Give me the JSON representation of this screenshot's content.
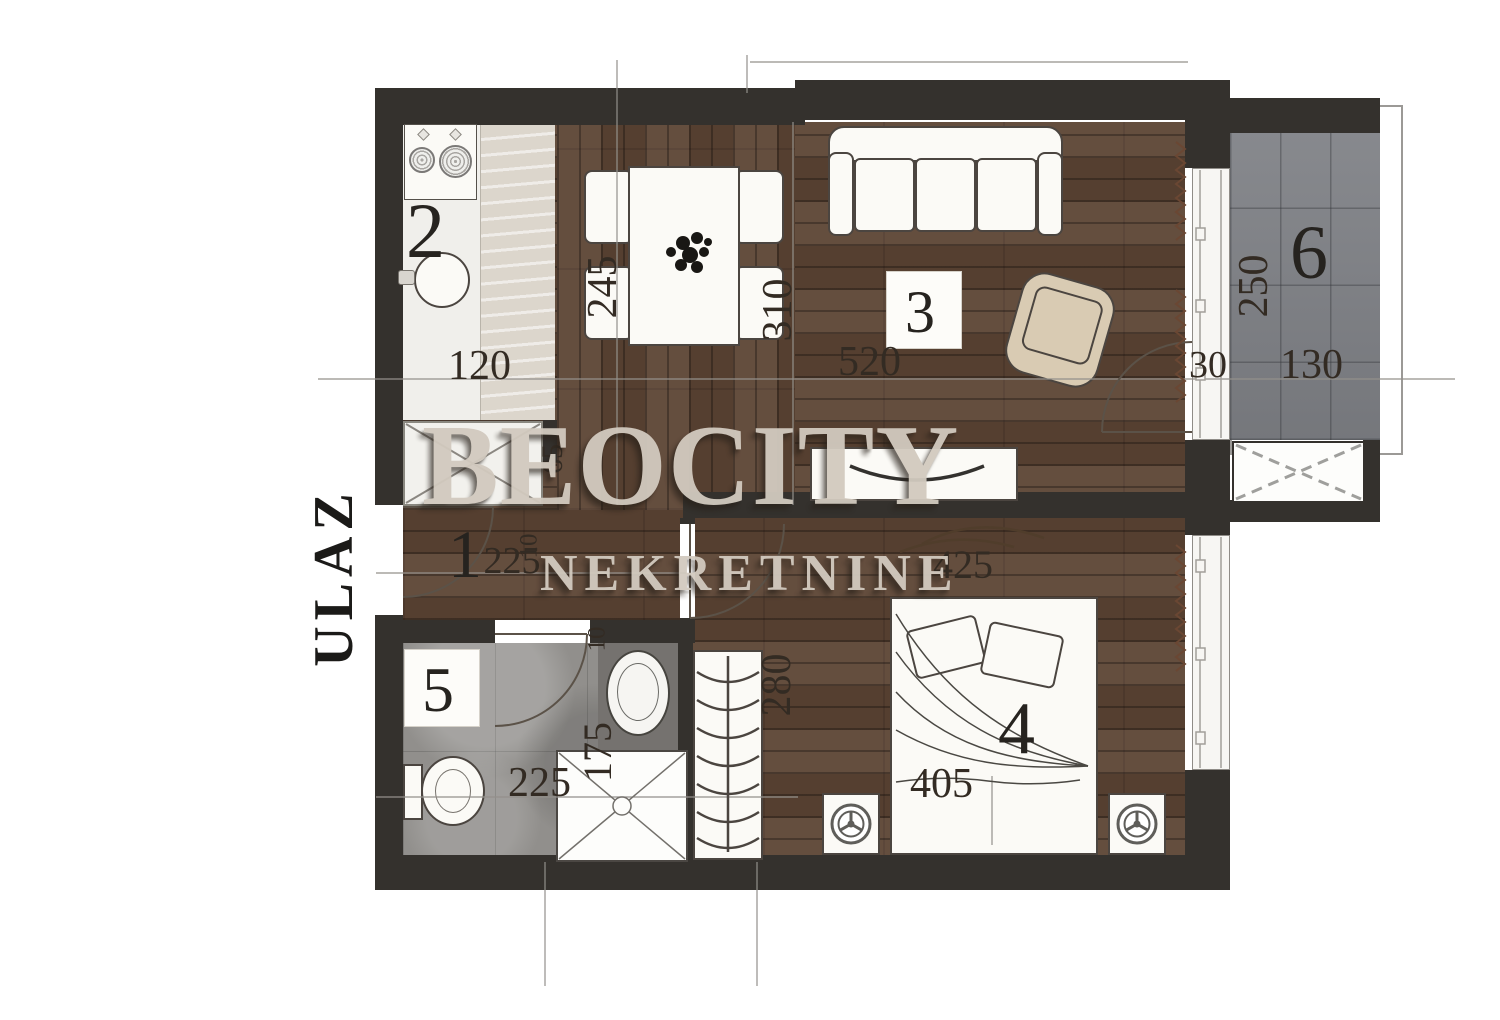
{
  "watermark": {
    "brand": "BEOCITY",
    "subtitle": "NEKRETNINE"
  },
  "entrance": {
    "label": "ULAZ"
  },
  "rooms": {
    "hallway": {
      "number": "1"
    },
    "kitchen": {
      "number": "2"
    },
    "living": {
      "number": "3"
    },
    "bedroom": {
      "number": "4"
    },
    "bathroom": {
      "number": "5"
    },
    "terrace": {
      "number": "6"
    }
  },
  "dimensions": {
    "kitchen_width": "120",
    "dining_depth": "245",
    "dining_length": "310",
    "living_width": "520",
    "passage_width": "65",
    "hallway_length": "225",
    "hallway_wall": "10",
    "terrace_gap": "30",
    "terrace_depth": "250",
    "terrace_width": "130",
    "bedroom_width": "425",
    "wardrobe_depth": "280",
    "bathroom_depth": "175",
    "bathroom_width": "225",
    "bathroom_wall": "10",
    "bed_width": "405"
  },
  "colors": {
    "wall": "#34312d",
    "wood": "#5c4434",
    "terrace": "#7e8085",
    "bathroom": "#918f8c",
    "watermark": "#d2cabf"
  }
}
